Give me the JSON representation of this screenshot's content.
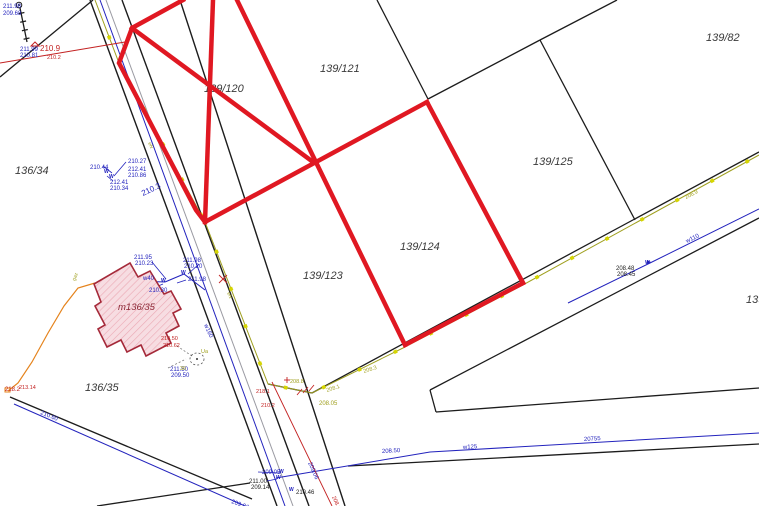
{
  "map": {
    "width": 759,
    "height": 506,
    "palette": {
      "highlight": "#e01822",
      "boundary": "#1c1c1c",
      "road_gray": "#9a9aa2",
      "water": "#2323bd",
      "en_olive": "#a0a020",
      "tick_yellow": "#d6d600",
      "gas": "#e5831c",
      "red_note": "#c32222",
      "maroon": "#8b2433",
      "building_fill": "#f7dde2",
      "building_hatch": "#eba8b4",
      "building_stroke": "#a52a3a",
      "label": "#3a3a3a",
      "black_note": "#222222"
    },
    "parcel_labels": [
      {
        "text": "136/34",
        "x": 15,
        "y": 174
      },
      {
        "text": "139/120",
        "x": 204,
        "y": 92
      },
      {
        "text": "139/121",
        "x": 320,
        "y": 72
      },
      {
        "text": "139/82",
        "x": 706,
        "y": 41
      },
      {
        "text": "139/125",
        "x": 533,
        "y": 165
      },
      {
        "text": "139/124",
        "x": 400,
        "y": 250
      },
      {
        "text": "139/123",
        "x": 303,
        "y": 279
      },
      {
        "text": "136/35",
        "x": 85,
        "y": 391
      },
      {
        "text": "139/",
        "x": 746,
        "y": 303
      }
    ],
    "building": {
      "label": "m136/35",
      "label_x": 118,
      "label_y": 310,
      "points": [
        [
          94,
          284
        ],
        [
          130,
          263
        ],
        [
          138,
          277
        ],
        [
          150,
          271
        ],
        [
          164,
          294
        ],
        [
          171,
          291
        ],
        [
          181,
          309
        ],
        [
          173,
          313
        ],
        [
          179,
          326
        ],
        [
          166,
          333
        ],
        [
          171,
          343
        ],
        [
          146,
          356
        ],
        [
          141,
          345
        ],
        [
          127,
          352
        ],
        [
          121,
          340
        ],
        [
          107,
          347
        ],
        [
          98,
          329
        ],
        [
          105,
          325
        ],
        [
          95,
          306
        ],
        [
          101,
          302
        ]
      ]
    },
    "red_outline": [
      [
        [
          183,
          0
        ],
        [
          132,
          28
        ],
        [
          119,
          63
        ],
        [
          196,
          210
        ],
        [
          205,
          222
        ]
      ],
      [
        [
          213,
          0
        ],
        [
          205,
          222
        ]
      ],
      [
        [
          237,
          0
        ],
        [
          405,
          345
        ]
      ],
      [
        [
          205,
          222
        ],
        [
          427,
          102
        ]
      ],
      [
        [
          132,
          28
        ],
        [
          313,
          162
        ]
      ],
      [
        [
          427,
          102
        ],
        [
          523,
          283
        ]
      ],
      [
        [
          405,
          345
        ],
        [
          523,
          283
        ]
      ]
    ],
    "boundary_lines": [
      [
        [
          377,
          0
        ],
        [
          428,
          99
        ]
      ],
      [
        [
          428,
          99
        ],
        [
          540,
          40
        ]
      ],
      [
        [
          540,
          40
        ],
        [
          617,
          0
        ]
      ],
      [
        [
          540,
          40
        ],
        [
          635,
          220
        ]
      ],
      [
        [
          312,
          393
        ],
        [
          759,
          152
        ]
      ],
      [
        [
          268,
          384
        ],
        [
          312,
          393
        ]
      ],
      [
        [
          430,
          390
        ],
        [
          759,
          218
        ]
      ],
      [
        [
          430,
          390
        ],
        [
          436,
          412
        ]
      ],
      [
        [
          436,
          412
        ],
        [
          759,
          388
        ]
      ],
      [
        [
          348,
          466
        ],
        [
          759,
          444
        ]
      ],
      [
        [
          0,
          77
        ],
        [
          93,
          0
        ]
      ],
      [
        [
          10,
          397
        ],
        [
          252,
          499
        ]
      ],
      [
        [
          97,
          506
        ],
        [
          250,
          483
        ]
      ],
      [
        [
          20,
          8
        ],
        [
          27,
          42
        ]
      ],
      [
        [
          18.5,
          13.7
        ],
        [
          24.4,
          12.5
        ]
      ],
      [
        [
          20.2,
          22.2
        ],
        [
          26.1,
          21.0
        ]
      ],
      [
        [
          21.9,
          30.7
        ],
        [
          27.8,
          29.5
        ]
      ],
      [
        [
          23.6,
          39.2
        ],
        [
          29.5,
          38.0
        ]
      ]
    ],
    "road_lines": [
      [
        [
          90,
          0
        ],
        [
          277,
          506
        ]
      ],
      [
        [
          122,
          0
        ],
        [
          309,
          506
        ]
      ],
      [
        [
          180,
          0
        ],
        [
          345,
          506
        ]
      ]
    ],
    "gray_lines": [
      [
        [
          106,
          0
        ],
        [
          293,
          506
        ]
      ]
    ],
    "water_lines": [
      {
        "name": "w160",
        "points": [
          [
            100,
            0
          ],
          [
            285,
            506
          ]
        ]
      },
      {
        "name": "w40",
        "points": [
          [
            133,
            281
          ],
          [
            165,
            282
          ]
        ]
      },
      {
        "name": "w40-link",
        "points": [
          [
            165,
            282
          ],
          [
            184,
            274
          ],
          [
            205,
            290
          ]
        ]
      },
      {
        "name": "w125",
        "points": [
          [
            276,
            478
          ],
          [
            430,
            452
          ],
          [
            759,
            433
          ]
        ]
      },
      {
        "name": "w110",
        "points": [
          [
            568,
            303
          ],
          [
            650,
            263
          ],
          [
            759,
            209
          ]
        ]
      },
      {
        "name": "w-left",
        "points": [
          [
            14,
            404
          ],
          [
            245,
            506
          ]
        ]
      }
    ],
    "water_leaders": [
      [
        [
          103,
          166
        ],
        [
          112,
          173
        ]
      ],
      [
        [
          126,
          162
        ],
        [
          114,
          176
        ]
      ],
      [
        [
          113,
          181
        ],
        [
          107,
          176
        ]
      ],
      [
        [
          152,
          262
        ],
        [
          166,
          279
        ]
      ],
      [
        [
          199,
          264
        ],
        [
          188,
          274
        ]
      ],
      [
        [
          186,
          280
        ],
        [
          177,
          283
        ]
      ],
      [
        [
          151,
          289
        ],
        [
          163,
          284
        ]
      ],
      [
        [
          258,
          472
        ],
        [
          281,
          473
        ]
      ],
      [
        [
          267,
          481
        ],
        [
          277,
          479
        ]
      ]
    ],
    "en_line": {
      "points": [
        [
          95,
          0
        ],
        [
          119,
          63
        ],
        [
          205,
          222
        ],
        [
          268,
          384
        ],
        [
          312,
          393
        ],
        [
          403,
          348
        ],
        [
          521,
          286
        ],
        [
          759,
          155
        ]
      ],
      "tick_every": 40
    },
    "gas_line": {
      "points": [
        [
          95,
          283
        ],
        [
          78,
          288
        ],
        [
          64,
          306
        ],
        [
          48,
          333
        ],
        [
          32,
          362
        ],
        [
          18,
          383
        ],
        [
          8,
          391
        ]
      ],
      "end_symbol": {
        "x": 5,
        "y": 388,
        "w": 5,
        "h": 4
      }
    },
    "red_thin_lines": [
      [
        [
          0,
          63
        ],
        [
          125,
          42
        ]
      ],
      [
        [
          272,
          382
        ],
        [
          332,
          506
        ]
      ],
      [
        [
          297,
          395
        ],
        [
          302,
          389
        ]
      ],
      [
        [
          303,
          393
        ],
        [
          308,
          387
        ]
      ],
      [
        [
          309,
          391
        ],
        [
          314,
          385
        ]
      ],
      [
        [
          284,
          380
        ],
        [
          290,
          380
        ]
      ],
      [
        [
          287,
          377
        ],
        [
          287,
          383
        ]
      ],
      [
        [
          219,
          275
        ],
        [
          227,
          283
        ]
      ],
      [
        [
          219,
          283
        ],
        [
          227,
          275
        ]
      ]
    ],
    "dashed_leaders": [
      [
        [
          177,
          346
        ],
        [
          192,
          356
        ]
      ],
      [
        [
          168,
          368
        ],
        [
          186,
          359
        ]
      ]
    ],
    "annotations": [
      {
        "t": "211.98",
        "x": 3,
        "y": 8,
        "c": "water",
        "s": 6
      },
      {
        "t": "209.68",
        "x": 3,
        "y": 15,
        "c": "water",
        "s": 6
      },
      {
        "t": "211.99",
        "x": 20,
        "y": 51,
        "c": "water",
        "s": 6
      },
      {
        "t": "210.81",
        "x": 20,
        "y": 57,
        "c": "water",
        "s": 6
      },
      {
        "t": "210.9",
        "x": 40,
        "y": 51,
        "c": "red_note",
        "s": 8
      },
      {
        "t": "210.2",
        "x": 47,
        "y": 59,
        "c": "red_note",
        "s": 5.5
      },
      {
        "t": "210.44",
        "x": 90,
        "y": 169,
        "c": "water",
        "s": 6
      },
      {
        "t": "210.27",
        "x": 128,
        "y": 163,
        "c": "water",
        "s": 6
      },
      {
        "t": "212.41",
        "x": 128,
        "y": 171,
        "c": "water",
        "s": 6
      },
      {
        "t": "210.86",
        "x": 128,
        "y": 177,
        "c": "water",
        "s": 6
      },
      {
        "t": "212.41",
        "x": 110,
        "y": 184,
        "c": "water",
        "s": 6
      },
      {
        "t": "210.34",
        "x": 110,
        "y": 190,
        "c": "water",
        "s": 6
      },
      {
        "t": "210.3",
        "x": 143,
        "y": 196,
        "c": "water",
        "s": 8,
        "r": -25
      },
      {
        "t": "eN",
        "x": 148,
        "y": 143,
        "c": "en_olive",
        "s": 5,
        "r": 66
      },
      {
        "t": "eN",
        "x": 227,
        "y": 293,
        "c": "en_olive",
        "s": 5,
        "r": 66
      },
      {
        "t": "211.95",
        "x": 134,
        "y": 259,
        "c": "water",
        "s": 6
      },
      {
        "t": "210.23",
        "x": 135,
        "y": 265,
        "c": "water",
        "s": 6
      },
      {
        "t": "211.98",
        "x": 183,
        "y": 262,
        "c": "water",
        "s": 6
      },
      {
        "t": "210.20",
        "x": 184,
        "y": 268,
        "c": "water",
        "s": 6
      },
      {
        "t": "211.98",
        "x": 188,
        "y": 281,
        "c": "water",
        "s": 6
      },
      {
        "t": "w40",
        "x": 143,
        "y": 280,
        "c": "water",
        "s": 6
      },
      {
        "t": "210.30",
        "x": 149,
        "y": 292,
        "c": "water",
        "s": 6
      },
      {
        "t": "w160",
        "x": 204,
        "y": 325,
        "c": "water",
        "s": 6,
        "r": 66
      },
      {
        "t": "gaz",
        "x": 75,
        "y": 281,
        "c": "en_olive",
        "s": 5,
        "r": -68
      },
      {
        "t": "210.50",
        "x": 161,
        "y": 340,
        "c": "red_note",
        "s": 5.5
      },
      {
        "t": "210.62",
        "x": 163,
        "y": 347,
        "c": "red_note",
        "s": 5.5
      },
      {
        "t": "211.50",
        "x": 170,
        "y": 371,
        "c": "water",
        "s": 6
      },
      {
        "t": "209.50",
        "x": 171,
        "y": 377,
        "c": "water",
        "s": 6
      },
      {
        "t": "Ua",
        "x": 201,
        "y": 353,
        "c": "en_olive",
        "s": 5.5
      },
      {
        "t": "36",
        "x": 180,
        "y": 370,
        "c": "en_olive",
        "s": 5.5
      },
      {
        "t": "218.2",
        "x": 5,
        "y": 391,
        "c": "red_note",
        "s": 6
      },
      {
        "t": "213.14",
        "x": 19,
        "y": 389,
        "c": "red_note",
        "s": 5.5
      },
      {
        "t": "210.60",
        "x": 40,
        "y": 414,
        "c": "water",
        "s": 6,
        "r": 22
      },
      {
        "t": "218.1",
        "x": 256,
        "y": 393,
        "c": "red_note",
        "s": 5.5
      },
      {
        "t": "210.2",
        "x": 261,
        "y": 407,
        "c": "red_note",
        "s": 5.5
      },
      {
        "t": "208.8",
        "x": 290,
        "y": 383,
        "c": "en_olive",
        "s": 5.5
      },
      {
        "t": "208.05",
        "x": 319,
        "y": 405,
        "c": "en_olive",
        "s": 6
      },
      {
        "t": "208.1",
        "x": 327,
        "y": 392,
        "c": "en_olive",
        "s": 5.5,
        "r": -18
      },
      {
        "t": "208.3",
        "x": 364,
        "y": 373,
        "c": "en_olive",
        "s": 5.5,
        "r": -18
      },
      {
        "t": "206.9",
        "x": 686,
        "y": 199,
        "c": "en_olive",
        "s": 5.5,
        "r": -27
      },
      {
        "t": "209.05",
        "x": 262,
        "y": 474,
        "c": "water",
        "s": 6
      },
      {
        "t": "211.00",
        "x": 249,
        "y": 483,
        "c": "black_note",
        "s": 6
      },
      {
        "t": "209.14",
        "x": 251,
        "y": 489,
        "c": "black_note",
        "s": 6
      },
      {
        "t": "210.46",
        "x": 296,
        "y": 494,
        "c": "black_note",
        "s": 6
      },
      {
        "t": "209.96",
        "x": 231,
        "y": 503,
        "c": "water",
        "s": 6,
        "r": 20
      },
      {
        "t": "209.06",
        "x": 308,
        "y": 463,
        "c": "water",
        "s": 6,
        "r": 66
      },
      {
        "t": "208.0",
        "x": 332,
        "y": 497,
        "c": "red_note",
        "s": 5.5,
        "r": 66
      },
      {
        "t": "208.50",
        "x": 382,
        "y": 453,
        "c": "water",
        "s": 6,
        "r": -3
      },
      {
        "t": "w125",
        "x": 463,
        "y": 449,
        "c": "water",
        "s": 6,
        "r": -3
      },
      {
        "t": "20755",
        "x": 584,
        "y": 441,
        "c": "water",
        "s": 6,
        "r": -3
      },
      {
        "t": "w110",
        "x": 687,
        "y": 243,
        "c": "water",
        "s": 6,
        "r": -26
      },
      {
        "t": "208.48",
        "x": 616,
        "y": 270,
        "c": "black_note",
        "s": 6
      },
      {
        "t": "208.45",
        "x": 617,
        "y": 276,
        "c": "black_note",
        "s": 6
      }
    ],
    "valve_symbols": [
      {
        "x": 161,
        "y": 282
      },
      {
        "x": 181,
        "y": 274
      },
      {
        "x": 104,
        "y": 173
      },
      {
        "x": 109,
        "y": 178
      },
      {
        "x": 279,
        "y": 473
      },
      {
        "x": 276,
        "y": 479
      },
      {
        "x": 289,
        "y": 491
      },
      {
        "x": 645,
        "y": 264
      }
    ],
    "point_symbols": {
      "control_circle": {
        "x": 19,
        "y": 5,
        "r": 2.8
      },
      "benchmark_triangle": {
        "x": 35,
        "y": 46,
        "size": 4
      },
      "ua_circle": {
        "x": 197,
        "y": 359,
        "rx": 7,
        "ry": 6
      },
      "arrow": {
        "x": 651,
        "y": 262
      }
    }
  }
}
